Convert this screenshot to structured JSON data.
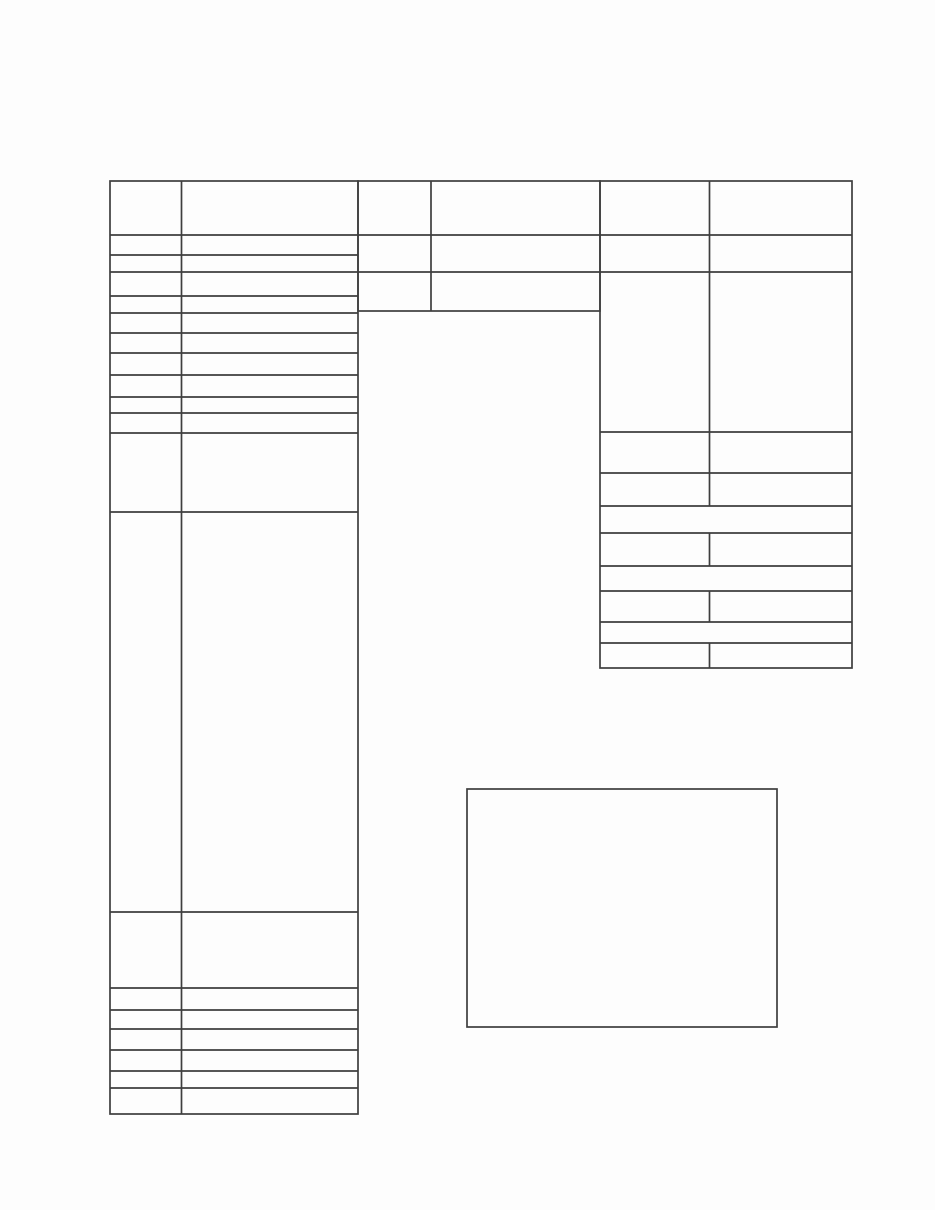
{
  "document": {
    "kind": "blank scanned form page",
    "visible_text": "",
    "colors": {
      "page_background": "#fdfdfd",
      "table_line_color": "#3e3e3e"
    },
    "left_table": {
      "columns": 2,
      "row_count": 20,
      "all_cells_blank": true
    },
    "middle_table": {
      "columns": 2,
      "row_count": 3,
      "all_cells_blank": true
    },
    "right_table": {
      "columns": 2,
      "row_count": 11,
      "merged_full_width_row_indexes": [
        6,
        8,
        10
      ],
      "all_cells_blank": true
    },
    "empty_box": {
      "content": ""
    }
  }
}
